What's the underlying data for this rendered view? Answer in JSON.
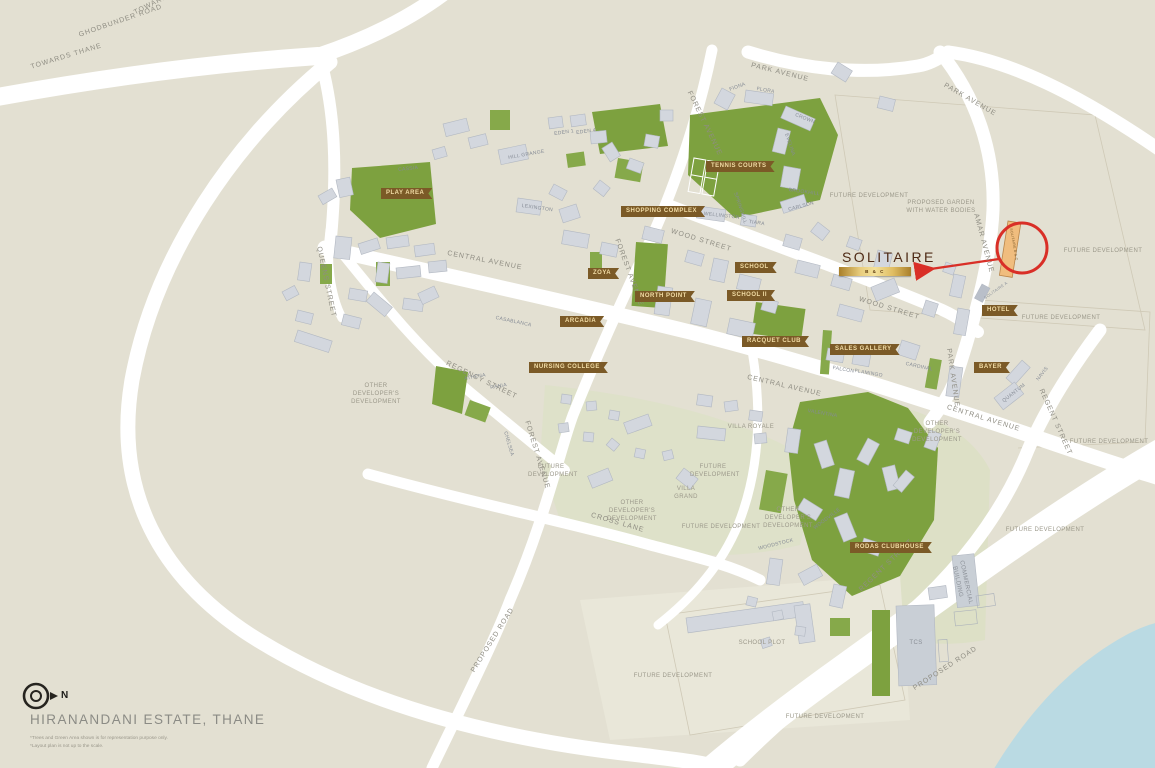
{
  "map_title": "HIRANANDANI ESTATE, THANE",
  "north_label": "N",
  "disclaimers": [
    "*Trees and Green Area shown is for representation purpose only.",
    "*Layout plan is not up to the scale."
  ],
  "callout": {
    "title": "SOLITAIRE",
    "bar_label": "B & C",
    "building_label": "SOLITAIRE B & C",
    "adjacent_label": "SOLITAIRE A"
  },
  "roads": {
    "towards_thane": "TOWARDS THANE",
    "ghodbunder_road": "GHODBUNDER ROAD",
    "towards_borivli": "TOWARDS BORIVLI",
    "park_avenue": "PARK AVENUE",
    "amar_avenue": "AMAR AVENUE",
    "forest_avenue": "FOREST AVENUE",
    "wood_street": "WOOD STREET",
    "central_avenue": "CENTRAL AVENUE",
    "queens_street": "QUEENS STREET",
    "regency_street": "REGENCY STREET",
    "regent_street": "REGENT STREET",
    "cross_lane": "CROSS LANE",
    "proposed_road": "PROPOSED ROAD"
  },
  "tags": {
    "play_area": "PLAY AREA",
    "shopping_complex": "SHOPPING COMPLEX",
    "tennis_courts": "TENNIS COURTS",
    "zoya": "ZOYA",
    "north_point": "NORTH POINT",
    "school": "SCHOOL",
    "school_ii": "SCHOOL II",
    "arcadia": "ARCADIA",
    "nursing_college": "NURSING COLLEGE",
    "racquet_club": "RACQUET CLUB",
    "sales_gallery": "SALES GALLERY",
    "hotel": "HOTEL",
    "bayer": "BAYER",
    "rodas_clubhouse": "RODAS CLUBHOUSE"
  },
  "areas": {
    "future_development": "FUTURE DEVELOPMENT",
    "proposed_garden": "PROPOSED GARDEN WITH WATER BODIES",
    "other_developers": "OTHER DEVELOPER'S DEVELOPMENT",
    "school_plot": "SCHOOL PLOT",
    "tcs": "TCS",
    "commercial_building": "COMMERCIAL BUILDING",
    "villa_royale": "VILLA ROYALE",
    "villa_grand": "VILLA GRAND"
  },
  "buildings": {
    "eden1": "EDEN 1",
    "eden4": "EDEN 4",
    "hill_grange": "HILL GRANGE",
    "lexington": "LEXINGTON",
    "wellington": "WELLINGTON",
    "tiara": "TIARA",
    "springhill": "SPRINGHILL",
    "fiona": "FIONA",
    "flora": "FLORA",
    "crown": "CROWN",
    "evelina": "EVELINA",
    "brookhill": "BROOKHILL",
    "carlson": "CARLSON",
    "cassia": "CASSIA",
    "athena": "ATHENA",
    "rania": "RANIA",
    "chelsea": "CHELSEA",
    "falcon": "FALCON",
    "flamingo": "FLAMINGO",
    "cardinal": "CARDINAL",
    "casablanca": "CASABLANCA",
    "valentina": "VALENTINA",
    "quantum": "QUANTUM",
    "navis": "NAVIS",
    "woodstock": "WOODSTOCK",
    "woodville": "WOODVILLE"
  },
  "colors": {
    "background": "#e3e0d2",
    "road": "#ffffff",
    "green": "#7da13f",
    "building": "#d3d7de",
    "tag_brown": "#7b5a27",
    "tag_text": "#f2dda6",
    "gold": "#d9b257",
    "accent_red": "#d92f27",
    "water": "#badae3",
    "solitaire_highlight": "#f0bd7e"
  }
}
